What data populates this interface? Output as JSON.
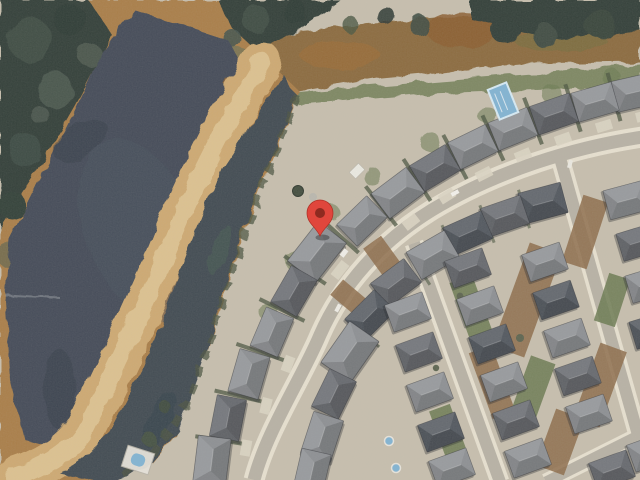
{
  "map": {
    "aria_label": "Satellite map view with a red location marker on a house beside a pond",
    "marker": {
      "transform": "translate(320,236)",
      "color": "#E0463C",
      "dot_color": "#8E2A20"
    },
    "palette": {
      "base": "#c7bfae",
      "water": "#3f4754",
      "forest": "#2f3a34",
      "forest_light": "#59675c",
      "marsh": "#a97c45",
      "marsh_dark": "#8a5c2e",
      "levee": "#cfa96f",
      "levee_light": "#e0c795",
      "field": "#8a683a",
      "field_green": "#5e6c44",
      "channel": "#3c4650",
      "shrub": "#47523d",
      "street": "#b8b2a5",
      "sidewalk": "#e9e2d1",
      "concrete": "#ddd6c4",
      "lawn": "#68784e",
      "dirt": "#8c6a47",
      "roof_mid": "#8b8e92",
      "roof_dark": "#63666c",
      "roof_navy": "#4e545c",
      "roof_light": "#a3a5a8",
      "pool": "#7fb3d4",
      "enclosure": "#e8e5dd"
    }
  }
}
